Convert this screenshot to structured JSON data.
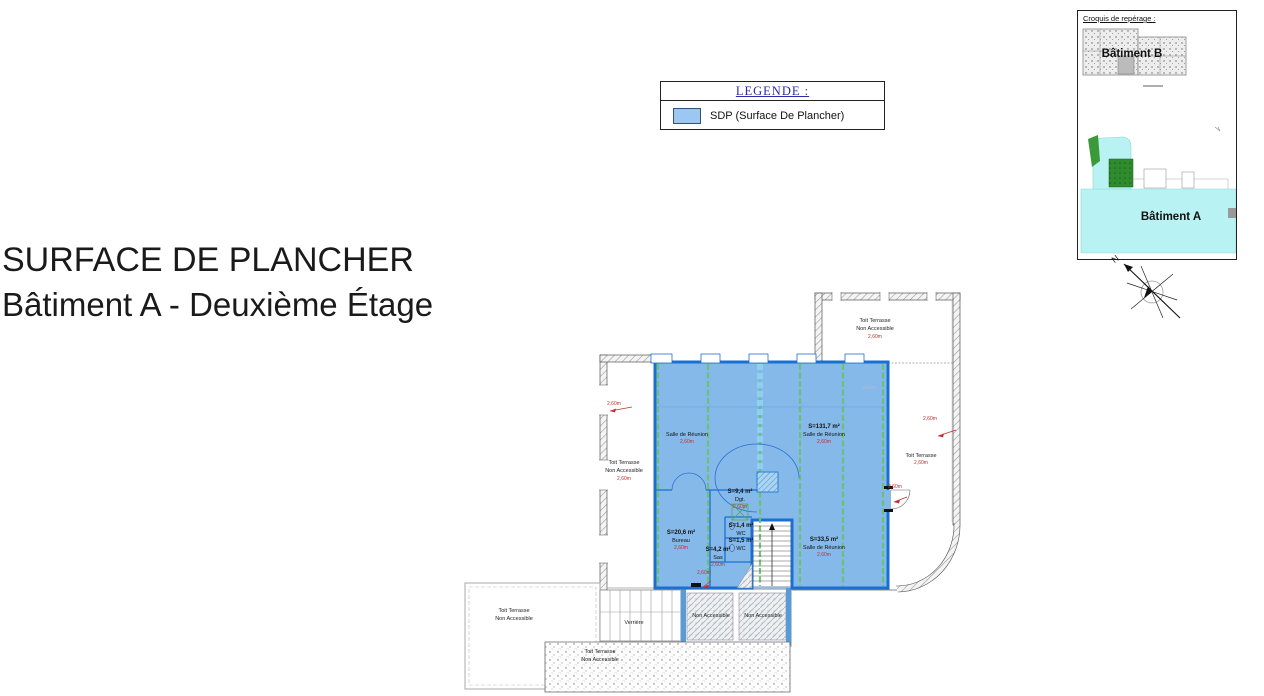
{
  "titles": {
    "line1": "SURFACE DE PLANCHER",
    "line2": "Bâtiment A - Deuxième Étage"
  },
  "legend": {
    "header": "LEGENDE :",
    "item_label": "SDP (Surface De Plancher)",
    "swatch_color": "#9CC7F0"
  },
  "croquis": {
    "title": "Croquis de repérage :",
    "batiment_b_label": "Bâtiment B",
    "batiment_a_label": "Bâtiment A"
  },
  "compass": {
    "north": "N"
  },
  "plan": {
    "rooms": {
      "salle_left": {
        "name": "Salle de Réunion",
        "annotation": "2,60m"
      },
      "salle_main": {
        "area": "S=131,7 m²",
        "name": "Salle de Réunion",
        "annotation": "2,60m"
      },
      "degagement": {
        "area": "S=9,4 m²",
        "name": "Dgt.",
        "annotation": "2,60m"
      },
      "bureau": {
        "area": "S=20,6 m²",
        "name": "Bureau",
        "annotation": "2,60m"
      },
      "wc_1": {
        "area": "S=1,4 m²",
        "name": "WC"
      },
      "wc_2": {
        "area": "S=1,5 m²",
        "name": "WC"
      },
      "sas": {
        "area": "S=4,2 m²",
        "name": "Sas",
        "annotation": "2,60m"
      },
      "salle_33": {
        "area": "S=33,5 m²",
        "name": "Salle de Réunion",
        "annotation": "2,60m"
      }
    },
    "terraces": {
      "top_right": {
        "line1": "Toit Terrasse",
        "line2": "Non Accessible",
        "annotation": "2,60m"
      },
      "right": {
        "line1": "Toit Terrasse",
        "annotation": "2,60m"
      },
      "left": {
        "line1": "Toit Terrasse",
        "line2": "Non Accessible",
        "annotation": "2,60m"
      },
      "bottom_left": {
        "line1": "Toit Terrasse",
        "line2": "Non Accessible"
      },
      "bottom": {
        "line1": "Toit Terrasse",
        "line2": "Non Accessible"
      }
    },
    "verriere_label": "Verrière",
    "panel_left": "Non Accessible",
    "panel_right": "Non Accessible",
    "annotations": {
      "left": "2,60m",
      "right": "2,60m",
      "door": "2,60m",
      "bottom": "2,60m"
    },
    "colors": {
      "sdp_fill": "#85B9EA",
      "sdp_border": "#1B6FD0",
      "grid_green": "#6CC06C",
      "annotation_red": "#C03030",
      "croquis_cyan": "#B8F2F2"
    }
  }
}
